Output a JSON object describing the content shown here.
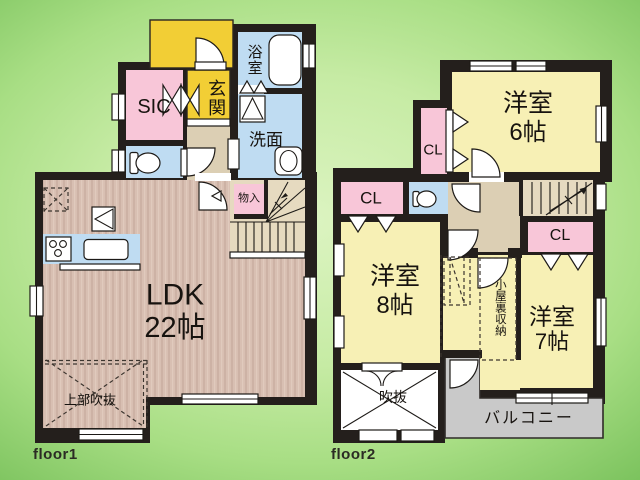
{
  "floors": {
    "f1": {
      "label": "floor1",
      "rooms": {
        "ldk": {
          "name": "LDK",
          "size": "22帖"
        },
        "sic": {
          "name": "SIC"
        },
        "genkan": {
          "name": "玄関"
        },
        "bath": {
          "name": "浴室"
        },
        "washroom": {
          "name": "洗面"
        },
        "storage": {
          "name": "物入"
        },
        "open_ceiling": {
          "name": "上部吹抜"
        }
      }
    },
    "f2": {
      "label": "floor2",
      "rooms": {
        "bedroom6": {
          "name": "洋室",
          "size": "6帖"
        },
        "bedroom8": {
          "name": "洋室",
          "size": "8帖"
        },
        "bedroom7": {
          "name": "洋室",
          "size": "7帖"
        },
        "closet_a": {
          "name": "CL"
        },
        "closet_b": {
          "name": "CL"
        },
        "closet_c": {
          "name": "CL"
        },
        "attic_storage": {
          "name": "小屋裏収納"
        },
        "void": {
          "name": "吹抜"
        },
        "balcony": {
          "name": "バルコニー"
        }
      }
    }
  },
  "colors": {
    "wall": "#241f1c",
    "room_yellow": "#f7f0b5",
    "entry_yellow": "#f2ce35",
    "pink": "#f8c6d8",
    "blue": "#bfdcf2",
    "wood": "#d7bcb0",
    "hall_tan": "#dccfb4",
    "stair_tan": "#e6dac0",
    "balcony_gray": "#c9c9c9",
    "background_green": "#a8de84"
  }
}
